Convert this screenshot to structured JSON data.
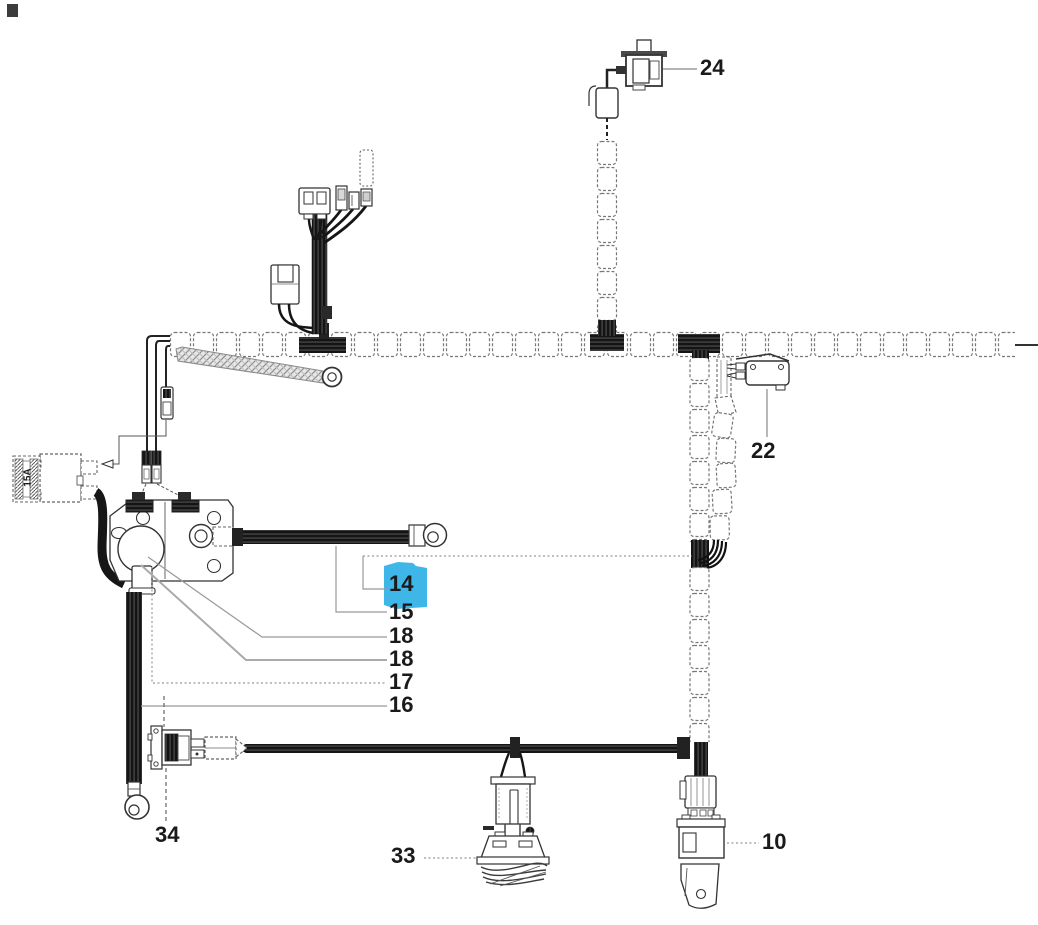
{
  "diagram": {
    "kind": "wiring-harness-parts-diagram",
    "highlight_color": "#3fb6e8",
    "fuse_rating": "15A",
    "callouts": [
      {
        "ref": "24",
        "highlighted": false
      },
      {
        "ref": "22",
        "highlighted": false
      },
      {
        "ref": "14",
        "highlighted": true
      },
      {
        "ref": "15",
        "highlighted": false
      },
      {
        "ref": "18",
        "highlighted": false
      },
      {
        "ref": "18",
        "highlighted": false
      },
      {
        "ref": "17",
        "highlighted": false
      },
      {
        "ref": "16",
        "highlighted": false
      },
      {
        "ref": "34",
        "highlighted": false
      },
      {
        "ref": "33",
        "highlighted": false
      },
      {
        "ref": "10",
        "highlighted": false
      }
    ]
  }
}
